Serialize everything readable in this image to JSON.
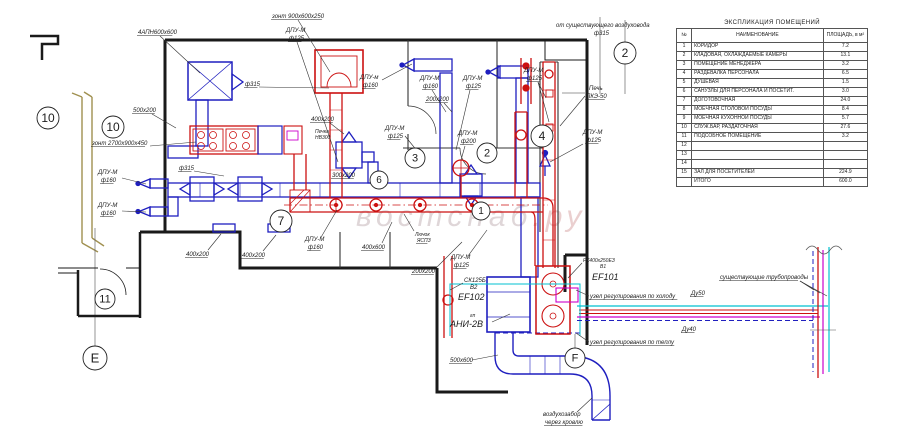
{
  "watermark": {
    "part1": "востснаб",
    "part2": ".ру",
    "color1": "#b09aa0",
    "color2": "#cc8888"
  },
  "explication_table": {
    "title": "ЭКСПЛИКАЦИЯ ПОМЕЩЕНИЙ",
    "columns": [
      "№",
      "НАИМЕНОВАНИЕ",
      "ПЛОЩАДЬ, в м²"
    ],
    "rows": [
      [
        "1",
        "КОРИДОР",
        "7.2"
      ],
      [
        "2",
        "КЛАДОВАЯ, ОХЛАЖДАЕМЫЕ КАМЕРЫ",
        "13.1"
      ],
      [
        "3",
        "ПОМЕЩЕНИЕ МЕНЕДЖЕРА",
        "3.2"
      ],
      [
        "4",
        "РАЗДЕВАЛКА ПЕРСОНАЛА",
        "6.5"
      ],
      [
        "5",
        "ДУШЕВАЯ",
        "1.5"
      ],
      [
        "6",
        "САНУЗЛЫ ДЛЯ ПЕРСОНАЛА И ПОСЕТИТ.",
        "3.0"
      ],
      [
        "7",
        "ДОГОТОВОЧНАЯ",
        "24.0"
      ],
      [
        "8",
        "МОЕЧНАЯ СТОЛОВОЙ ПОСУДЫ",
        "8.4"
      ],
      [
        "9",
        "МОЕЧНАЯ КУХОННОЙ ПОСУДЫ",
        "5.7"
      ],
      [
        "10",
        "СЛУЖ.БАР, РАЗДАТОЧНАЯ",
        "27.6"
      ],
      [
        "11",
        "ПОДСОБНОЕ ПОМЕЩЕНИЕ",
        "3.2"
      ],
      [
        "12",
        "",
        ""
      ],
      [
        "13",
        "",
        ""
      ],
      [
        "14",
        "",
        ""
      ],
      [
        "15",
        "ЗАЛ ДЛЯ ПОСЕТИТЕЛЕЙ",
        "224.9"
      ],
      [
        "",
        "ИТОГО",
        "600.0"
      ]
    ]
  },
  "plan": {
    "colors": {
      "walls": "#1a1a1a",
      "supply_air_duct": "#1f1fbf",
      "exhaust_air_duct": "#cc1111",
      "heating_pipe": "#cc00cc",
      "cold_pipe": "#00c0d0",
      "existing_wall": "#a09050"
    },
    "axis_markers": [
      {
        "t": "10",
        "x": 48,
        "y": 118,
        "r": 11
      },
      {
        "t": "10",
        "x": 113,
        "y": 127,
        "r": 11
      },
      {
        "t": "11",
        "x": 105,
        "y": 299,
        "r": 10
      },
      {
        "t": "E",
        "x": 95,
        "y": 358,
        "r": 12
      },
      {
        "t": "7",
        "x": 281,
        "y": 221,
        "r": 11
      },
      {
        "t": "6",
        "x": 379,
        "y": 180,
        "r": 9
      },
      {
        "t": "3",
        "x": 415,
        "y": 158,
        "r": 10
      },
      {
        "t": "2",
        "x": 487,
        "y": 153,
        "r": 10
      },
      {
        "t": "1",
        "x": 481,
        "y": 211,
        "r": 9
      },
      {
        "t": "4",
        "x": 542,
        "y": 136,
        "r": 11
      },
      {
        "t": "2",
        "x": 625,
        "y": 53,
        "r": 11
      },
      {
        "t": "F",
        "x": 575,
        "y": 358,
        "r": 10
      }
    ],
    "labels": [
      {
        "text": "зонт 900х600х250",
        "x": 272,
        "y": 18,
        "u": 1,
        "leads": [
          [
            298,
            20,
            330,
            72
          ]
        ]
      },
      {
        "text": "4АПН600х600",
        "x": 138,
        "y": 34,
        "u": 1,
        "leads": [
          [
            160,
            36,
            200,
            73
          ]
        ]
      },
      {
        "text": "ДПУ-М",
        "x": 286,
        "y": 32
      },
      {
        "text": "ф125",
        "x": 289,
        "y": 40,
        "u": 1,
        "leads": [
          [
            297,
            42,
            338,
            162
          ]
        ]
      },
      {
        "text": "ДПУ-м",
        "x": 360,
        "y": 79
      },
      {
        "text": "ф160",
        "x": 363,
        "y": 87,
        "u": 1,
        "leads": [
          [
            382,
            80,
            412,
            64
          ]
        ]
      },
      {
        "text": "ДПУ-М",
        "x": 420,
        "y": 80
      },
      {
        "text": "ф160",
        "x": 423,
        "y": 88,
        "u": 1,
        "leads": [
          [
            432,
            90,
            446,
            112
          ]
        ]
      },
      {
        "text": "ДПУ-М",
        "x": 463,
        "y": 80
      },
      {
        "text": "ф125",
        "x": 466,
        "y": 88,
        "u": 1,
        "leads": [
          [
            470,
            90,
            456,
            150
          ]
        ]
      },
      {
        "text": "ДПУ-М",
        "x": 524,
        "y": 72
      },
      {
        "text": "ф125",
        "x": 527,
        "y": 80,
        "u": 1,
        "leads": [
          [
            538,
            82,
            546,
            98
          ],
          [
            538,
            82,
            549,
            122
          ]
        ]
      },
      {
        "text": "от существующего воздуховода",
        "x": 556,
        "y": 27
      },
      {
        "text": "ф315",
        "x": 594,
        "y": 35
      },
      {
        "text": "Печь",
        "x": 589,
        "y": 90
      },
      {
        "text": "ПКЭ-50",
        "x": 586,
        "y": 98,
        "u": 1,
        "leads": [
          [
            585,
            93,
            562,
            93
          ],
          [
            585,
            96,
            560,
            126
          ]
        ]
      },
      {
        "text": "ДПУ-М",
        "x": 583,
        "y": 134
      },
      {
        "text": "ф125",
        "x": 586,
        "y": 142,
        "u": 1,
        "leads": [
          [
            583,
            144,
            550,
            162
          ]
        ]
      },
      {
        "text": "ф315",
        "x": 245,
        "y": 86,
        "u": 1,
        "leads": [
          [
            259,
            87,
            329,
            88
          ]
        ]
      },
      {
        "text": "500х200",
        "x": 133,
        "y": 112,
        "u": 1,
        "leads": [
          [
            152,
            114,
            176,
            128
          ]
        ]
      },
      {
        "text": "зонт 2700х900х450",
        "x": 92,
        "y": 145,
        "u": 1,
        "leads": [
          [
            150,
            146,
            196,
            142
          ]
        ]
      },
      {
        "text": "ДПУ-М",
        "x": 98,
        "y": 174
      },
      {
        "text": "ф160",
        "x": 101,
        "y": 182,
        "u": 1,
        "leads": [
          [
            122,
            178,
            146,
            184
          ]
        ]
      },
      {
        "text": "ДПУ-М",
        "x": 98,
        "y": 207
      },
      {
        "text": "ф160",
        "x": 101,
        "y": 215,
        "u": 1,
        "leads": [
          [
            122,
            211,
            146,
            212
          ]
        ]
      },
      {
        "text": "ф315",
        "x": 179,
        "y": 170,
        "u": 1,
        "leads": [
          [
            194,
            171,
            224,
            176
          ]
        ]
      },
      {
        "text": "400х200",
        "x": 311,
        "y": 121,
        "u": 1,
        "leads": [
          [
            330,
            123,
            344,
            134
          ]
        ]
      },
      {
        "text": "Печка",
        "x": 315,
        "y": 133,
        "size": 5
      },
      {
        "text": "НВ300",
        "x": 315,
        "y": 139,
        "size": 5
      },
      {
        "text": "300х200",
        "x": 332,
        "y": 177,
        "u": 1
      },
      {
        "text": "200х200",
        "x": 426,
        "y": 101,
        "u": 1,
        "leads": [
          [
            444,
            103,
            452,
            112
          ]
        ]
      },
      {
        "text": "ДПУ-М",
        "x": 385,
        "y": 130
      },
      {
        "text": "ф125",
        "x": 388,
        "y": 138,
        "u": 1,
        "leads": [
          [
            405,
            136,
            418,
            152
          ]
        ]
      },
      {
        "text": "ДПУ-М",
        "x": 458,
        "y": 135
      },
      {
        "text": "ф200",
        "x": 461,
        "y": 143,
        "u": 1,
        "leads": [
          [
            465,
            146,
            461,
            160
          ]
        ]
      },
      {
        "text": "ДПУ-М",
        "x": 305,
        "y": 241
      },
      {
        "text": "ф160",
        "x": 308,
        "y": 249,
        "u": 1,
        "leads": [
          [
            320,
            239,
            337,
            210
          ]
        ]
      },
      {
        "text": "400х200",
        "x": 186,
        "y": 256,
        "u": 1,
        "leads": [
          [
            208,
            250,
            221,
            234
          ]
        ]
      },
      {
        "text": "400х200",
        "x": 242,
        "y": 257,
        "u": 1,
        "leads": [
          [
            263,
            251,
            276,
            235
          ]
        ]
      },
      {
        "text": "400х600",
        "x": 362,
        "y": 249,
        "u": 1,
        "leads": [
          [
            382,
            243,
            392,
            222
          ]
        ]
      },
      {
        "text": "Лючок",
        "x": 415,
        "y": 236,
        "size": 5
      },
      {
        "text": "ЯСПЗ",
        "x": 417,
        "y": 242,
        "size": 5,
        "u": 1,
        "leads": [
          [
            414,
            231,
            404,
            214
          ]
        ]
      },
      {
        "text": "200х200",
        "x": 412,
        "y": 273,
        "u": 1,
        "leads": [
          [
            436,
            268,
            462,
            242
          ]
        ]
      },
      {
        "text": "ДПУ-М",
        "x": 451,
        "y": 259
      },
      {
        "text": "ф125",
        "x": 454,
        "y": 267,
        "u": 1,
        "leads": [
          [
            468,
            256,
            487,
            230
          ]
        ]
      },
      {
        "text": "СК125Б",
        "x": 464,
        "y": 282,
        "leads": [
          [
            463,
            283,
            450,
            290
          ]
        ]
      },
      {
        "text": "В2",
        "x": 470,
        "y": 289
      },
      {
        "text": "EF102",
        "x": 458,
        "y": 300,
        "size": 9
      },
      {
        "text": "гп",
        "x": 470,
        "y": 317,
        "size": 5
      },
      {
        "text": "АНИ-2В",
        "x": 450,
        "y": 327,
        "size": 9,
        "leads": [
          [
            492,
            322,
            510,
            314
          ]
        ]
      },
      {
        "text": "РК400х250ЕЗ",
        "x": 583,
        "y": 262,
        "size": 5,
        "leads": [
          [
            582,
            263,
            568,
            278
          ]
        ]
      },
      {
        "text": "В1",
        "x": 600,
        "y": 268,
        "size": 5
      },
      {
        "text": "EF101",
        "x": 592,
        "y": 280,
        "size": 9
      },
      {
        "text": "узел регулирования по холоду",
        "x": 590,
        "y": 298,
        "u": 1,
        "leads": [
          [
            589,
            296,
            576,
            290
          ]
        ]
      },
      {
        "text": "узел регулирования по теплу",
        "x": 590,
        "y": 344,
        "u": 1,
        "leads": [
          [
            589,
            342,
            576,
            333
          ]
        ]
      },
      {
        "text": "Ду50",
        "x": 691,
        "y": 295,
        "u": 1
      },
      {
        "text": "Ду40",
        "x": 682,
        "y": 331,
        "u": 1
      },
      {
        "text": "существующие трубопроводы",
        "x": 720,
        "y": 279,
        "u": 1,
        "leads": [
          [
            800,
            281,
            814,
            290
          ],
          [
            800,
            281,
            820,
            293
          ],
          [
            800,
            281,
            827,
            296
          ]
        ]
      },
      {
        "text": "500х600",
        "x": 450,
        "y": 362,
        "u": 1,
        "leads": [
          [
            472,
            360,
            498,
            355
          ]
        ]
      },
      {
        "text": "воздухозабор",
        "x": 543,
        "y": 416
      },
      {
        "text": "через кровлю",
        "x": 545,
        "y": 424,
        "u": 1,
        "leads": [
          [
            577,
            412,
            592,
            398
          ]
        ]
      }
    ]
  }
}
